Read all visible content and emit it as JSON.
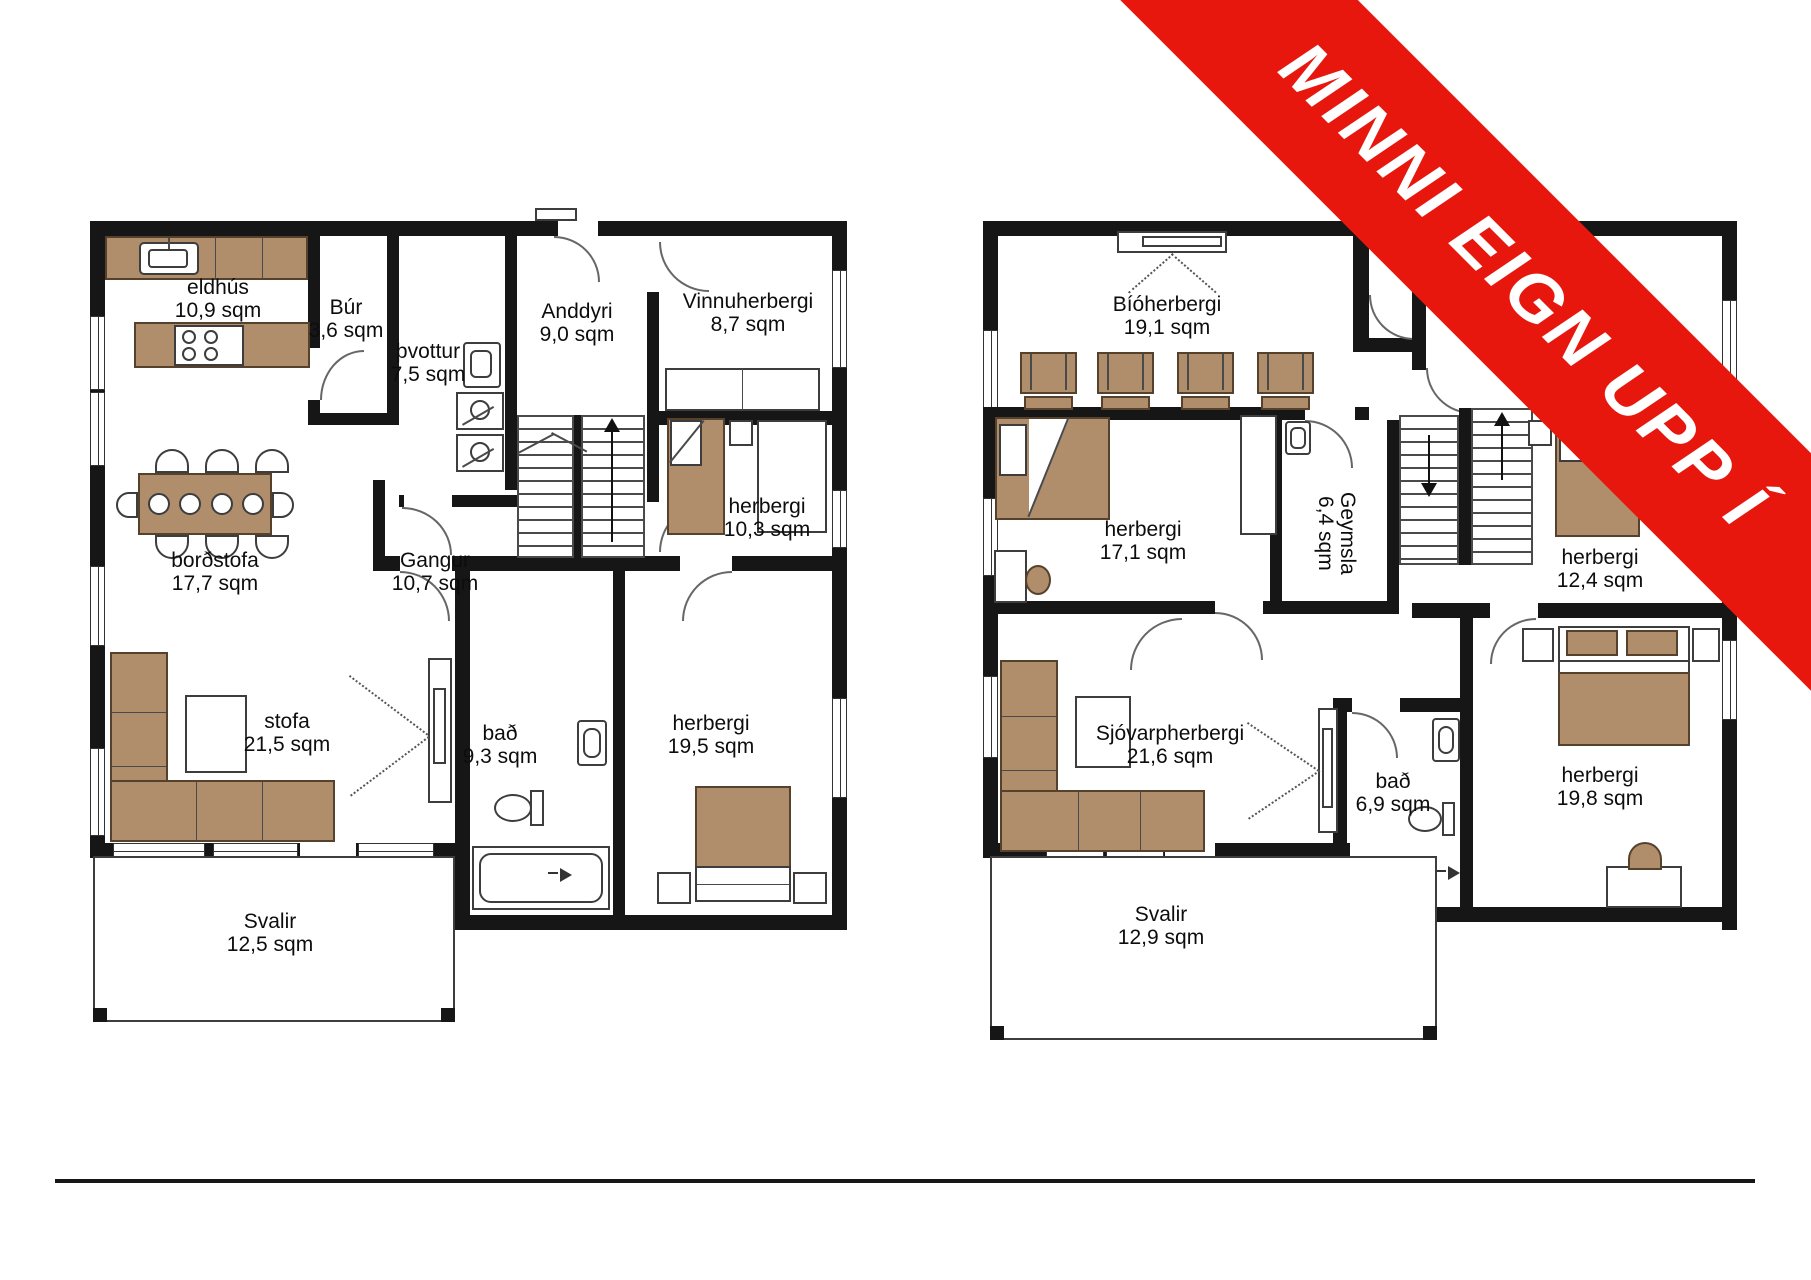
{
  "banner": {
    "text": "MINNI EIGN UPP Í",
    "color": "#e7170e"
  },
  "colors": {
    "wall": "#161616",
    "furniture_brown": "#b08d6b",
    "banner_red": "#e7170e"
  },
  "floors": [
    {
      "side": "left",
      "rooms": [
        {
          "name": "eldhús",
          "area": "10,9 sqm"
        },
        {
          "name": "Búr",
          "area": "3,6 sqm"
        },
        {
          "name": "þvottur",
          "area": "7,5 sqm"
        },
        {
          "name": "Anddyri",
          "area": "9,0 sqm"
        },
        {
          "name": "Vinnuherbergi",
          "area": "8,7 sqm"
        },
        {
          "name": "herbergi",
          "area": "10,3 sqm"
        },
        {
          "name": "borðstofa",
          "area": "17,7 sqm"
        },
        {
          "name": "Gangur",
          "area": "10,7 sqm"
        },
        {
          "name": "stofa",
          "area": "21,5 sqm"
        },
        {
          "name": "bað",
          "area": "9,3 sqm"
        },
        {
          "name": "herbergi",
          "area": "19,5 sqm"
        },
        {
          "name": "Svalir",
          "area": "12,5 sqm"
        }
      ]
    },
    {
      "side": "right",
      "rooms": [
        {
          "name": "Bíóherbergi",
          "area": "19,1 sqm"
        },
        {
          "name": "herbergi",
          "area": "17,1 sqm"
        },
        {
          "name": "Geymsla",
          "area": "6,4 sqm"
        },
        {
          "name": "herbergi",
          "area": "12,4 sqm"
        },
        {
          "name": "Sjóvarpherbergi",
          "area": "21,6 sqm"
        },
        {
          "name": "bað",
          "area": "6,9 sqm"
        },
        {
          "name": "herbergi",
          "area": "19,8 sqm"
        },
        {
          "name": "Svalir",
          "area": "12,9 sqm"
        }
      ]
    }
  ]
}
